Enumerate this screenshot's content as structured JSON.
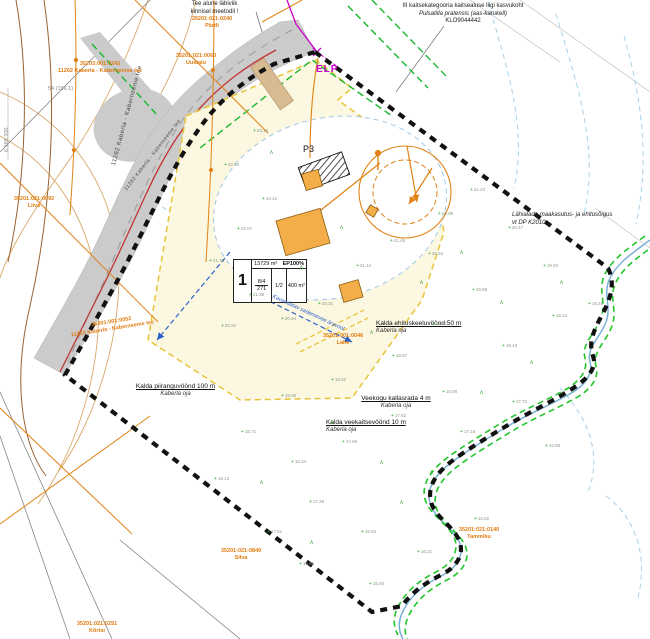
{
  "map": {
    "notes": {
      "road_crossing_1": "Tee alune läbiviik",
      "road_crossing_2": "kinnisel meetodil !",
      "species_1": "III kaitsekategooria kaitsealuse liigi kasvukoht",
      "species_2": "Pulsatilla pratensis (aas-karukell)",
      "species_3": "KLO9044442",
      "neighbor_1": "Lähialade maakasutus- ja ehitusõigus",
      "neighbor_2": "vt DP K2010",
      "elp": "ELP",
      "p3": "P3",
      "drain": "Kavandatav sademevee äravool",
      "coord": "6 585 200",
      "pipe_ref": "54 (196.1)"
    },
    "plot_table": {
      "number": "1",
      "area": "13729 m²",
      "land_use": "EP100%",
      "c1": "8/4",
      "c2": "271",
      "c3": "1/2",
      "c4": "400 m²"
    },
    "zones": [
      {
        "title": "Kalda piiranguvöönd 100 m",
        "sub": "Kaberla oja"
      },
      {
        "title": "Kalda ehituskeeluvöönd 50 m",
        "sub": "Kaberla oja"
      },
      {
        "title": "Veekogu kallasrada 4 m",
        "sub": "Kaberla oja"
      },
      {
        "title": "Kalda veekaitsevöönd 10 m",
        "sub": "Kaberla oja"
      }
    ],
    "roads": [
      {
        "label": "11262 Kaberla - Kaberneeme tee"
      },
      {
        "label": "11262 Kaberla - Kaberneeme tee"
      }
    ],
    "cadastral": [
      {
        "code": "35201:021:0240",
        "name": "Pärtli"
      },
      {
        "code": "35201:021:0060",
        "name": "Uustalu"
      },
      {
        "code": "35203:001:0243",
        "name": "11262 Kaberla - Kaberneeme tee"
      },
      {
        "code": "35201:021:0092",
        "name": "Liiva"
      },
      {
        "code": "35201:001:0052",
        "name": "11262 Kaberla - Kaberneeme tee"
      },
      {
        "code": "35201:021:0840",
        "name": "Silva"
      },
      {
        "code": "35201:021:0140",
        "name": "Tammiku"
      },
      {
        "code": "35201:001:0046",
        "name": "Lahe"
      },
      {
        "code": "35201:021:0251",
        "name": "Kõrtsi"
      }
    ],
    "spots": [
      [
        253,
        128,
        "23.12"
      ],
      [
        224,
        162,
        "22.84"
      ],
      [
        262,
        196,
        "22.41"
      ],
      [
        237,
        226,
        "22.07"
      ],
      [
        209,
        258,
        "21.76"
      ],
      [
        249,
        292,
        "21.38"
      ],
      [
        221,
        323,
        "20.92"
      ],
      [
        281,
        316,
        "20.64"
      ],
      [
        318,
        301,
        "20.31"
      ],
      [
        356,
        263,
        "21.12"
      ],
      [
        390,
        238,
        "21.45"
      ],
      [
        438,
        211,
        "20.88"
      ],
      [
        470,
        187,
        "21.24"
      ],
      [
        508,
        225,
        "20.47"
      ],
      [
        543,
        263,
        "19.93"
      ],
      [
        472,
        287,
        "19.58"
      ],
      [
        432,
        321,
        "19.21"
      ],
      [
        392,
        353,
        "18.87"
      ],
      [
        331,
        377,
        "18.52"
      ],
      [
        281,
        393,
        "19.05"
      ],
      [
        241,
        429,
        "18.71"
      ],
      [
        291,
        459,
        "18.34"
      ],
      [
        342,
        439,
        "17.96"
      ],
      [
        391,
        413,
        "17.62"
      ],
      [
        442,
        389,
        "18.08"
      ],
      [
        502,
        343,
        "18.43"
      ],
      [
        552,
        313,
        "19.12"
      ],
      [
        309,
        499,
        "17.28"
      ],
      [
        361,
        529,
        "16.94"
      ],
      [
        267,
        529,
        "17.51"
      ],
      [
        214,
        476,
        "18.12"
      ],
      [
        460,
        429,
        "17.15"
      ],
      [
        512,
        399,
        "17.72"
      ],
      [
        545,
        443,
        "16.88"
      ],
      [
        588,
        301,
        "19.46"
      ],
      [
        474,
        516,
        "16.52"
      ],
      [
        417,
        549,
        "16.21"
      ],
      [
        369,
        581,
        "15.94"
      ],
      [
        299,
        561,
        "16.65"
      ],
      [
        428,
        251,
        "20.62"
      ]
    ],
    "veg": [
      [
        270,
        150
      ],
      [
        300,
        265
      ],
      [
        340,
        225
      ],
      [
        370,
        330
      ],
      [
        420,
        280
      ],
      [
        460,
        250
      ],
      [
        500,
        300
      ],
      [
        330,
        420
      ],
      [
        380,
        460
      ],
      [
        430,
        470
      ],
      [
        260,
        480
      ],
      [
        480,
        390
      ],
      [
        530,
        360
      ],
      [
        560,
        280
      ],
      [
        310,
        540
      ],
      [
        400,
        500
      ]
    ],
    "colors": {
      "boundary": "#111111",
      "parcel_orange": "#e07c10",
      "road_fill": "#cbcbcb",
      "plot_fill": "#fcf7e0",
      "building_fill": "#f3ae4a",
      "stream_green": "#22c52a",
      "magenta": "#cc00cc",
      "red_line": "#c23333",
      "blue": "#2b62c9",
      "contour_tan": "#d8a868"
    }
  }
}
